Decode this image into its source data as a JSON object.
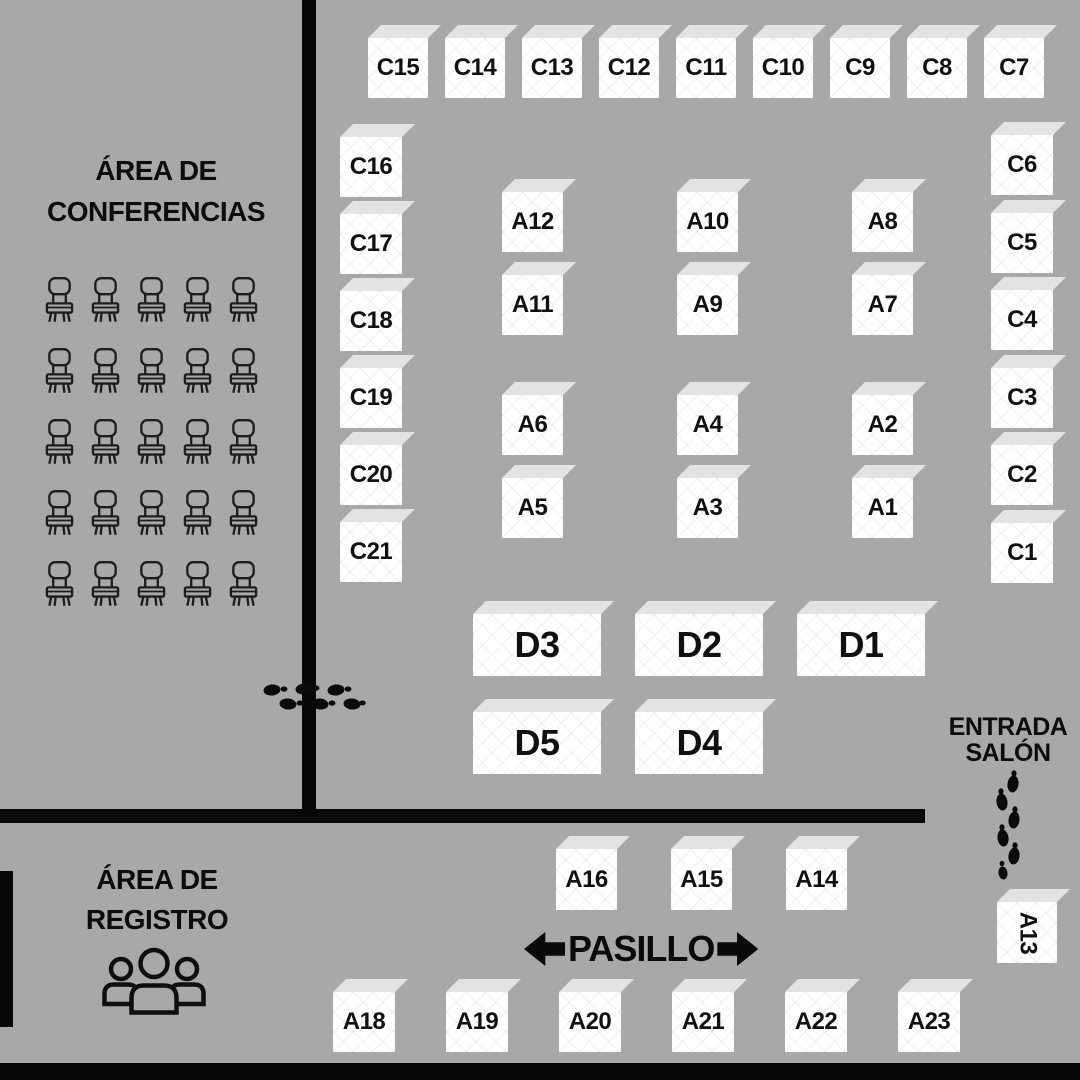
{
  "colors": {
    "background": "#a8a8a8",
    "booth_face": "#ffffff",
    "booth_top": "#e3e3e3",
    "walls_and_ink": "#0a0a0a"
  },
  "labels": {
    "conference_area_line1": "ÁREA DE",
    "conference_area_line2": "CONFERENCIAS",
    "registration_area_line1": "ÁREA DE",
    "registration_area_line2": "REGISTRO",
    "entrance_line1": "ENTRADA",
    "entrance_line2": "SALÓN",
    "aisle": "PASILLO"
  },
  "conference_seating": {
    "rows": 5,
    "cols": 5
  },
  "booths": {
    "c_top_row": [
      "C15",
      "C14",
      "C13",
      "C12",
      "C11",
      "C10",
      "C9",
      "C8",
      "C7"
    ],
    "c_left_column": [
      "C16",
      "C17",
      "C18",
      "C19",
      "C20",
      "C21"
    ],
    "c_right_column": [
      "C6",
      "C5",
      "C4",
      "C3",
      "C2",
      "C1"
    ],
    "a_upper_grid": [
      "A12",
      "A10",
      "A8",
      "A11",
      "A9",
      "A7"
    ],
    "a_lower_grid": [
      "A6",
      "A4",
      "A2",
      "A5",
      "A3",
      "A1"
    ],
    "d_upper_row": [
      "D3",
      "D2",
      "D1"
    ],
    "d_lower_row": [
      "D5",
      "D4"
    ],
    "a_aisle_row": [
      "A16",
      "A15",
      "A14"
    ],
    "a_bottom_row": [
      "A18",
      "A19",
      "A20",
      "A21",
      "A22",
      "A23"
    ],
    "a_entrance_booth": "A13"
  }
}
